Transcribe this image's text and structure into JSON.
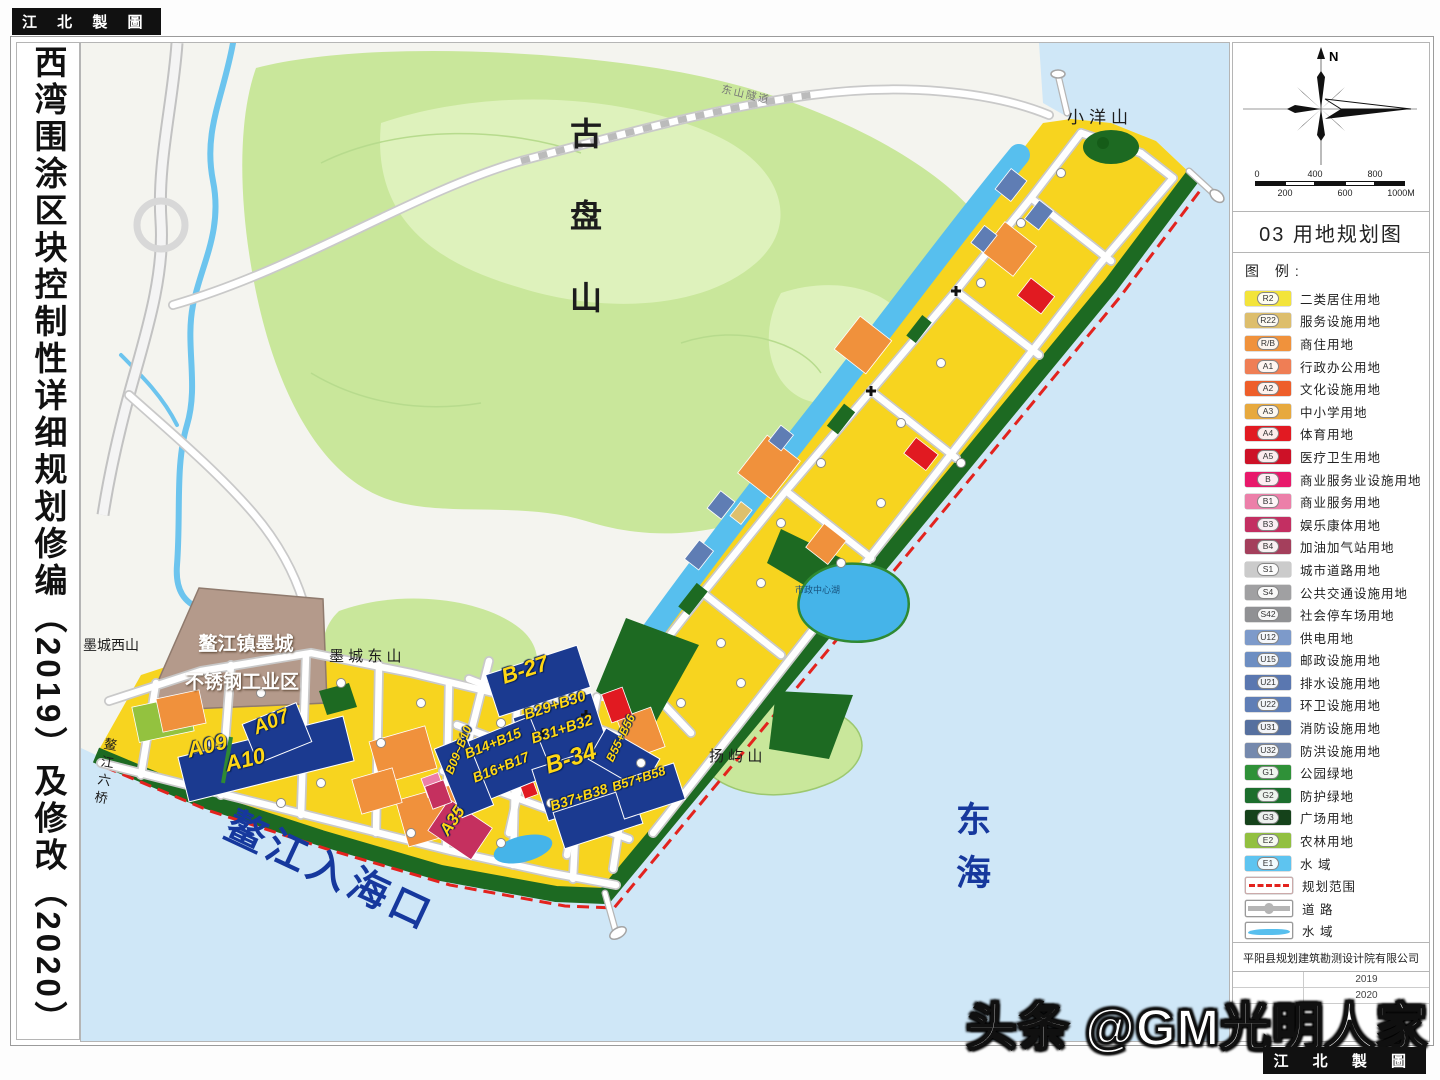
{
  "stamps": {
    "top_left": "江 北 製 圖",
    "bottom_right": "江 北 製 圖"
  },
  "sheet_title_vertical": "西湾围涂区块控制性详细规划修编（2019）及修改（2020）",
  "watermark": "头条 @GM光明人家",
  "right_panel": {
    "north_label": "N",
    "scale_bar": {
      "top_labels": [
        "0",
        "400",
        "800"
      ],
      "bottom_labels": [
        "200",
        "600",
        "1000M"
      ]
    },
    "map_title": "03 用地规划图",
    "legend_header": "图  例:",
    "legend_items": [
      {
        "code": "R2",
        "color": "#f3e43b",
        "label": "二类居住用地"
      },
      {
        "code": "R22",
        "color": "#ddbe6c",
        "label": "服务设施用地"
      },
      {
        "code": "R/B",
        "color": "#f0923c",
        "label": "商住用地"
      },
      {
        "code": "A1",
        "color": "#ef7e55",
        "label": "行政办公用地"
      },
      {
        "code": "A2",
        "color": "#ee5e2a",
        "label": "文化设施用地"
      },
      {
        "code": "A3",
        "color": "#e7a93e",
        "label": "中小学用地"
      },
      {
        "code": "A4",
        "color": "#e21a22",
        "label": "体育用地"
      },
      {
        "code": "A5",
        "color": "#cd1127",
        "label": "医疗卫生用地"
      },
      {
        "code": "B",
        "color": "#e8196b",
        "label": "商业服务业设施用地"
      },
      {
        "code": "B1",
        "color": "#ec7fa9",
        "label": "商业服务用地"
      },
      {
        "code": "B3",
        "color": "#c32f62",
        "label": "娱乐康体用地"
      },
      {
        "code": "B4",
        "color": "#a43f5c",
        "label": "加油加气站用地"
      },
      {
        "code": "S1",
        "color": "#cbcbcb",
        "label": "城市道路用地"
      },
      {
        "code": "S4",
        "color": "#a0a0a2",
        "label": "公共交通设施用地"
      },
      {
        "code": "S42",
        "color": "#909194",
        "label": "社会停车场用地"
      },
      {
        "code": "U12",
        "color": "#7d9aca",
        "label": "供电用地"
      },
      {
        "code": "U15",
        "color": "#6d8ec2",
        "label": "邮政设施用地"
      },
      {
        "code": "U21",
        "color": "#5a77b0",
        "label": "排水设施用地"
      },
      {
        "code": "U22",
        "color": "#5f7eb6",
        "label": "环卫设施用地"
      },
      {
        "code": "U31",
        "color": "#56709f",
        "label": "消防设施用地"
      },
      {
        "code": "U32",
        "color": "#7589ad",
        "label": "防洪设施用地"
      },
      {
        "code": "G1",
        "color": "#2f9138",
        "label": "公园绿地"
      },
      {
        "code": "G2",
        "color": "#1c6e2d",
        "label": "防护绿地"
      },
      {
        "code": "G3",
        "color": "#15421a",
        "label": "广场用地"
      },
      {
        "code": "E2",
        "color": "#92c040",
        "label": "农林用地"
      },
      {
        "code": "E1",
        "color": "#5ec4f0",
        "label": "水  域"
      },
      {
        "type": "dash",
        "label": "规划范围"
      },
      {
        "type": "road",
        "label": "道  路"
      },
      {
        "type": "water",
        "label": "水  域"
      }
    ],
    "company": "平阳县规划建筑勘测设计院有限公司",
    "date_rows": [
      {
        "value": "2019"
      },
      {
        "value": "2020"
      }
    ]
  },
  "map": {
    "labels": {
      "gupanshan": "古盘山",
      "xiaoyangshan": "小洋山",
      "mochengxishan": "墨城西山",
      "mochengdongshan": "墨 城 东 山",
      "industrial_line1": "鳌江镇墨城",
      "industrial_line2": "不锈钢工业区",
      "yangyushan": "扬 屿 山",
      "donghai": "东海",
      "estuary": "鳌江入海口",
      "bridge": "鳌江六桥",
      "central_lake": "市政中心湖",
      "tunnel": "东山隧道"
    },
    "blocks": {
      "a09": "A09",
      "a10": "A10",
      "a07": "A07",
      "a35": "A35",
      "b27": "B-27",
      "b29_30": "B29+B30",
      "b31_32": "B31+B32",
      "b14_15": "B14+B15",
      "b16_17": "B16+B17",
      "b09_10": "B09~B10",
      "b34": "B-34",
      "b37_38": "B37+B38",
      "b55_56": "B55+B56",
      "b57_58": "B57+B58"
    },
    "colors": {
      "sea": "#cfe7f7",
      "hill": "#c9e79b",
      "hill_light": "#def2bc",
      "band": "#f7d41f",
      "navy": "#1b3a90",
      "dgreen": "#1d6a22",
      "green": "#2f9138",
      "orange": "#f0913c",
      "red": "#e11a21",
      "ublue": "#5f7db4",
      "lake": "#45b4e9",
      "olive": "#93c23f",
      "tan": "#dec06d",
      "crimson": "#c5305f",
      "pink": "#ec7fa9",
      "brown": "#b49a8b",
      "block_label": "#ffd714",
      "water_line": "#57bfee",
      "title_blue": "#16389d",
      "dash_red": "#e3231e"
    }
  }
}
